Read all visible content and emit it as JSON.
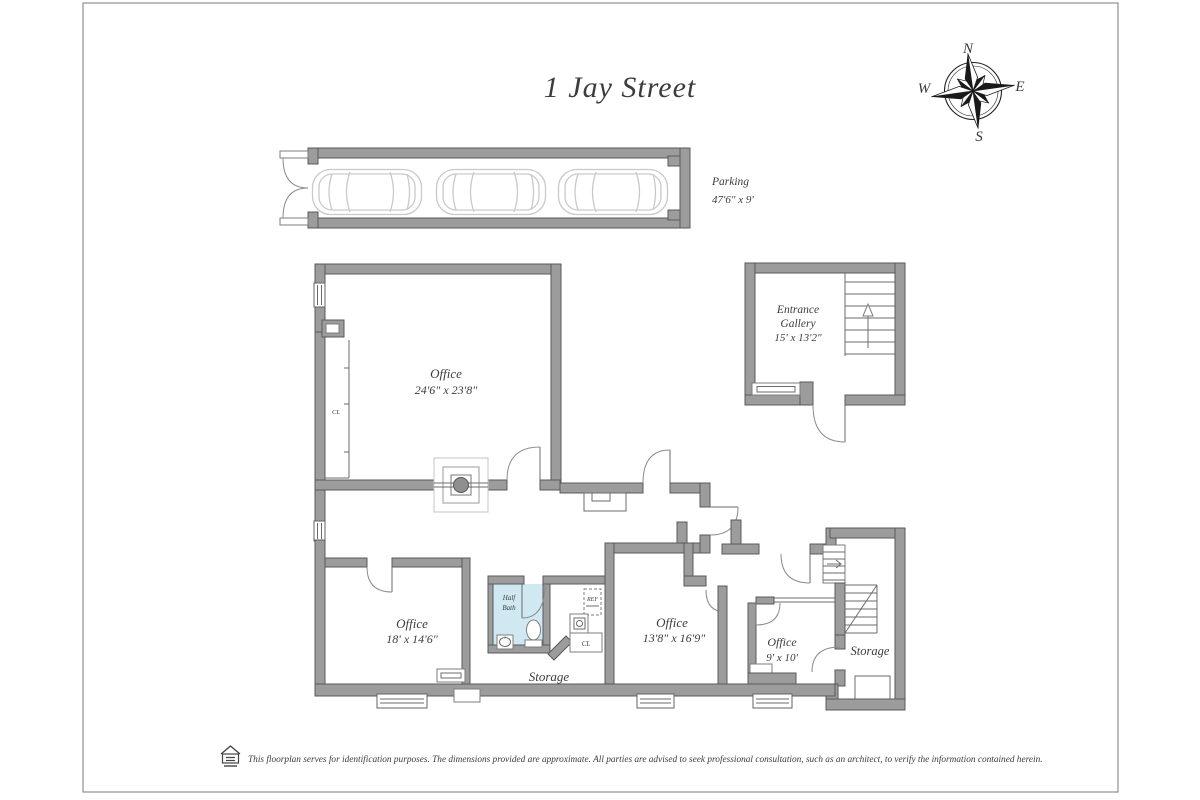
{
  "page": {
    "title": "1 Jay Street",
    "disclaimer": "This floorplan serves for identification purposes. The dimensions provided are approximate. All parties are advised to seek professional consultation, such as an architect, to verify the information contained herein."
  },
  "compass": {
    "north": "N",
    "south": "S",
    "east": "E",
    "west": "W"
  },
  "rooms": {
    "parking": {
      "name": "Parking",
      "dims": "47'6\" x 9'"
    },
    "entrance_gallery": {
      "line1": "Entrance",
      "line2": "Gallery",
      "dims": "15' x 13'2\""
    },
    "office_main": {
      "name": "Office",
      "dims": "24'6\" x 23'8\""
    },
    "office_left": {
      "name": "Office",
      "dims": "18' x 14'6\""
    },
    "office_middle": {
      "name": "Office",
      "dims": "13'8\" x 16'9\""
    },
    "office_small": {
      "name": "Office",
      "dims": "9' x 10'"
    },
    "half_bath": {
      "line1": "Half",
      "line2": "Bath"
    },
    "storage_left": {
      "name": "Storage"
    },
    "storage_right": {
      "name": "Storage"
    }
  },
  "labels": {
    "closet_main": "CL",
    "closet_small": "CL",
    "ref": "REF"
  }
}
